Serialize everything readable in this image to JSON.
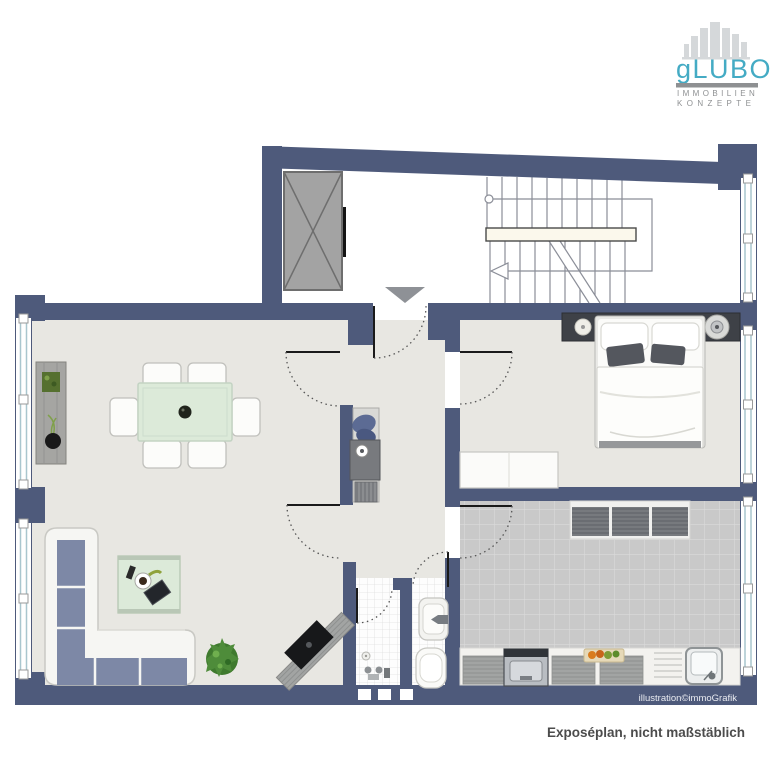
{
  "header": {
    "logo": {
      "icon": "skyline-buildings-icon",
      "brand": "gLUBO",
      "tagline_line1": "IMMOBILIEN",
      "tagline_line2": "KONZEPTE"
    }
  },
  "footer": {
    "credit": "illustration©immoGrafik",
    "disclaimer": "Exposéplan, nicht maßstäblich"
  },
  "colors": {
    "wall": "#4e5a7b",
    "floor": "#e8e7e2",
    "kitchen_tile": "#c9c9c9",
    "kitchen_grout": "#dadada",
    "bath_tile": "#fdfdfd",
    "bath_grout": "#e0e0e0",
    "window_frame": "#a9c6ce",
    "stair_line": "#8b8e98",
    "mint": "#dcead9",
    "sofa_cushion": "#7d88a6",
    "dark_strip": "#3e4147",
    "elevator_gray": "#a3a3a3",
    "logo_teal": "#44abc4",
    "logo_gray": "#8e9092",
    "credit_text": "#e9ebf1",
    "disclaimer_text": "#4c4c4c"
  },
  "plan_elements": [
    "elevator",
    "staircase",
    "entrance-arrow",
    "living-dining-room",
    "bedroom",
    "kitchen",
    "shower-room",
    "wc",
    "hallway-wardrobe",
    "windows",
    "doors"
  ]
}
